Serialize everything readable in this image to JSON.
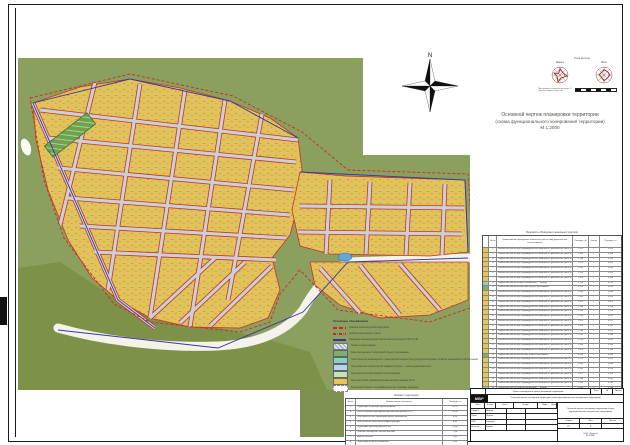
{
  "sheet": {
    "title": {
      "line1": "Основной чертеж планировки территории",
      "line2": "(схема функционального зонирования территории)",
      "line3": "М 1:2000"
    },
    "north_label": "N"
  },
  "wind": {
    "caption": "Роза ветров",
    "left_label": "Январь",
    "right_label": "Июль",
    "note1": "Повторяемость направлений ветра, %",
    "note2": "Средняя скорость ветра, м/с",
    "scale_label": "Линейный масштаб 1:2000"
  },
  "colors": {
    "zone_residential": "#e6c455",
    "zone_green": "#7fb069",
    "zone_engineering": "#8fcfc0",
    "zone_transport": "#b8d4e8",
    "zone_agro": "#cfe3a8",
    "boundary_red": "#c3342a",
    "boundary_blue": "#3a33a6"
  },
  "legend": {
    "title": "Условные обозначения",
    "items": [
      {
        "sw_bg": "repeating-linear-gradient(90deg,#c1272d 0 4px,transparent 4px 6px)",
        "sw_h": "1.6px",
        "sw_bd": "none",
        "label": "Граница проектируемой территории"
      },
      {
        "sw_bg": "repeating-linear-gradient(90deg,#c1272d 0 3px,transparent 3px 4px,#c1272d 4px 4.6px,transparent 4.6px 6px)",
        "sw_h": "1.6px",
        "sw_bd": "none",
        "label": "Граница населенного пункта"
      },
      {
        "sw_bg": "#3a33a6",
        "sw_h": "1.4px",
        "sw_bd": "none",
        "label": "Охранная зона воздушной линии электропередачи ЛЭП 10 кВ"
      },
      {
        "sw_bg": "repeating-linear-gradient(45deg,#aab4ba 0 1.5px,#e8ecee 1.5px 3px)",
        "sw_h": "5px",
        "sw_bd": "0.4px solid #778",
        "label": "Земли лесного фонда"
      },
      {
        "sw_bg": "#7fb069",
        "sw_h": "5px",
        "sw_bd": "0.4px solid #567",
        "label": "Зона озелененных территорий общего пользования"
      },
      {
        "sw_bg": "#8fcfc0",
        "sw_h": "5px",
        "sw_bd": "0.4px solid #567",
        "label": "Зона объектов инженерной и транспортной инфраструктуры (проектируемые объекты инженерного обеспечения)"
      },
      {
        "sw_bg": "#b8d4e8",
        "sw_h": "5px",
        "sw_bd": "0.4px solid #567",
        "label": "Зона объектов транспортной инфраструктуры — улично-дорожная сеть"
      },
      {
        "sw_bg": "#cfe3a8",
        "sw_h": "5px",
        "sw_bd": "0.4px solid #567",
        "label": "Зона сельскохозяйственного использования"
      },
      {
        "sw_bg": "#e6c455",
        "sw_h": "5px",
        "sw_bd": "0.4px solid #766",
        "label": "Зона застройки индивидуальными жилыми домами (Ж-1)"
      },
      {
        "sw_bg": "#ffffff",
        "sw_h": "5px",
        "sw_bd": "0.5px dashed #888",
        "label": "Территории общего пользования (улицы, проезды, проходы)"
      }
    ]
  },
  "plots_table": {
    "caption": "Ведомость образуемых земельных участков",
    "col_n": "№ п/п",
    "col_name": "Наименование образуемого земельного участка (вид разрешенного использования)",
    "col_area": "Площадь, м²",
    "col_cnt": "Кол-во",
    "col_note": "Площадь, га",
    "rows": [
      {
        "n": "1",
        "color": "#e6c455",
        "name": "Земельный участок для индивидуального жилищного строительства (зона Ж-1)",
        "area": "1 512",
        "cnt": "1",
        "note": "0,151"
      },
      {
        "n": "2",
        "color": "#e6c455",
        "name": "Земельный участок для индивидуального жилищного строительства (зона Ж-1)",
        "area": "1 485",
        "cnt": "1",
        "note": "0,149"
      },
      {
        "n": "3",
        "color": "#e6c455",
        "name": "Земельный участок для индивидуального жилищного строительства (зона Ж-1)",
        "area": "1 500",
        "cnt": "1",
        "note": "0,150"
      },
      {
        "n": "4",
        "color": "#e6c455",
        "name": "Земельный участок для индивидуального жилищного строительства (зона Ж-1)",
        "area": "1 523",
        "cnt": "1",
        "note": "0,152"
      },
      {
        "n": "5",
        "color": "#e6c455",
        "name": "Земельный участок для индивидуального жилищного строительства (зона Ж-1)",
        "area": "1 497",
        "cnt": "1",
        "note": "0,150"
      },
      {
        "n": "6",
        "color": "#e6c455",
        "name": "Земельный участок для индивидуального жилищного строительства (зона Ж-1)",
        "area": "1 505",
        "cnt": "1",
        "note": "0,151"
      },
      {
        "n": "7",
        "color": "#e6c455",
        "name": "Земельный участок для индивидуального жилищного строительства (зона Ж-1)",
        "area": "1 478",
        "cnt": "1",
        "note": "0,148"
      },
      {
        "n": "8",
        "color": "#8fcfc0",
        "name": "Земельный участок общего пользования — проезд",
        "area": "2 150",
        "cnt": "1",
        "note": "0,215"
      },
      {
        "n": "9",
        "color": "#7fb069",
        "name": "Земельный участок озеленения общего пользования",
        "area": "5 230",
        "cnt": "1",
        "note": "0,523"
      },
      {
        "n": "10",
        "color": "#e6c455",
        "name": "Земельный участок для индивидуального жилищного строительства (зона Ж-1)",
        "area": "1 490",
        "cnt": "1",
        "note": "0,149"
      },
      {
        "n": "11",
        "color": "#e6c455",
        "name": "Земельный участок для индивидуального жилищного строительства (зона Ж-1)",
        "area": "1 502",
        "cnt": "1",
        "note": "0,150"
      },
      {
        "n": "12",
        "color": "#e6c455",
        "name": "Земельный участок для индивидуального жилищного строительства (зона Ж-1)",
        "area": "1 515",
        "cnt": "1",
        "note": "0,152"
      },
      {
        "n": "13",
        "color": "#e6c455",
        "name": "Земельный участок для индивидуального жилищного строительства (зона Ж-1)",
        "area": "1 488",
        "cnt": "1",
        "note": "0,149"
      },
      {
        "n": "14",
        "color": "#e6c455",
        "name": "Земельный участок для индивидуального жилищного строительства (зона Ж-1)",
        "area": "1 500",
        "cnt": "1",
        "note": "0,150"
      },
      {
        "n": "15",
        "color": "#e6c455",
        "name": "Земельный участок для индивидуального жилищного строительства (зона Ж-1)",
        "area": "1 534",
        "cnt": "1",
        "note": "0,153"
      },
      {
        "n": "16",
        "color": "#e6c455",
        "name": "Земельный участок для индивидуального жилищного строительства (зона Ж-1)",
        "area": "1 470",
        "cnt": "1",
        "note": "0,147"
      },
      {
        "n": "17",
        "color": "#e6c455",
        "name": "Земельный участок для индивидуального жилищного строительства (зона Ж-1)",
        "area": "1 495",
        "cnt": "1",
        "note": "0,150"
      },
      {
        "n": "18",
        "color": "#e6c455",
        "name": "Земельный участок для индивидуального жилищного строительства (зона Ж-1)",
        "area": "1 508",
        "cnt": "1",
        "note": "0,151"
      },
      {
        "n": "19",
        "color": "#e6c455",
        "name": "Земельный участок для индивидуального жилищного строительства (зона Ж-1)",
        "area": "1 482",
        "cnt": "1",
        "note": "0,148"
      },
      {
        "n": "20",
        "color": "#e6c455",
        "name": "Земельный участок для индивидуального жилищного строительства (зона Ж-1)",
        "area": "1 519",
        "cnt": "1",
        "note": "0,152"
      },
      {
        "n": "21",
        "color": "#e6c455",
        "name": "Земельный участок для индивидуального жилищного строительства (зона Ж-1)",
        "area": "1 500",
        "cnt": "1",
        "note": "0,150"
      },
      {
        "n": "22",
        "color": "#e6c455",
        "name": "Земельный участок для индивидуального жилищного строительства (зона Ж-1)",
        "area": "1 476",
        "cnt": "1",
        "note": "0,148"
      },
      {
        "n": "23",
        "color": "#7fb069",
        "name": "Земельный участок озеленения общего пользования",
        "area": "3 640",
        "cnt": "1",
        "note": "0,364"
      },
      {
        "n": "24",
        "color": "#e6c455",
        "name": "Земельный участок для индивидуального жилищного строительства (зона Ж-1)",
        "area": "1 511",
        "cnt": "1",
        "note": "0,151"
      },
      {
        "n": "25",
        "color": "#e6c455",
        "name": "Земельный участок для индивидуального жилищного строительства (зона Ж-1)",
        "area": "1 493",
        "cnt": "1",
        "note": "0,149"
      },
      {
        "n": "26",
        "color": "#e6c455",
        "name": "Земельный участок для индивидуального жилищного строительства (зона Ж-1)",
        "area": "1 500",
        "cnt": "1",
        "note": "0,150"
      },
      {
        "n": "27",
        "color": "#e6c455",
        "name": "Земельный участок для индивидуального жилищного строительства (зона Ж-1)",
        "area": "1 527",
        "cnt": "1",
        "note": "0,153"
      },
      {
        "n": "28",
        "color": "#e6c455",
        "name": "Земельный участок для индивидуального жилищного строительства (зона Ж-1)",
        "area": "1 466",
        "cnt": "1",
        "note": "0,147"
      },
      {
        "n": "29",
        "color": "#e6c455",
        "name": "Земельный участок для индивидуального жилищного строительства (зона Ж-1)",
        "area": "1 504",
        "cnt": "1",
        "note": "0,150"
      },
      {
        "n": "30",
        "color": "#8fcfc0",
        "name": "Земельный участок общего пользования — проезд",
        "area": "1 980",
        "cnt": "1",
        "note": "0,198"
      },
      {
        "n": "31",
        "color": "#e6c455",
        "name": "Земельный участок для индивидуального жилищного строительства (зона Ж-1)",
        "area": "1 498",
        "cnt": "1",
        "note": "0,150"
      },
      {
        "n": "32",
        "color": "#e6c455",
        "name": "Земельный участок для индивидуального жилищного строительства (зона Ж-1)",
        "area": "1 515",
        "cnt": "1",
        "note": "0,152"
      },
      {
        "n": "33",
        "color": "#e6c455",
        "name": "Земельный участок для индивидуального жилищного строительства (зона Ж-1)",
        "area": "1 487",
        "cnt": "1",
        "note": "0,149"
      },
      {
        "n": "34",
        "color": "#e6c455",
        "name": "Земельный участок для индивидуального жилищного строительства (зона Ж-1)",
        "area": "1 500",
        "cnt": "1",
        "note": "0,150"
      },
      {
        "n": "35",
        "color": "#e6c455",
        "name": "Земельный участок для индивидуального жилищного строительства (зона Ж-1)",
        "area": "1 472",
        "cnt": "1",
        "note": "0,147"
      },
      {
        "n": "36",
        "color": "#e6c455",
        "name": "Земельный участок для индивидуального жилищного строительства (зона Ж-1)",
        "area": "1 526",
        "cnt": "1",
        "note": "0,153"
      },
      {
        "n": "37",
        "color": "#e6c455",
        "name": "Земельный участок для индивидуального жилищного строительства (зона Ж-1)",
        "area": "1 509",
        "cnt": "1",
        "note": "0,151"
      },
      {
        "n": "38",
        "color": "#8fcfc0",
        "name": "Земельный участок для размещения объектов инженерной инфраструктуры",
        "area": "860",
        "cnt": "1",
        "note": "0,086"
      }
    ]
  },
  "balance_table": {
    "caption": "Баланс территории",
    "col_n": "№ п/п",
    "col_name": "Наименование показателя",
    "col_val": "Площадь, га",
    "rows": [
      {
        "n": "1",
        "name": "Территория в границах проектирования",
        "val": "82,70"
      },
      {
        "n": "2",
        "name": "Зона застройки индивидуальными жилыми домами (Ж-1)",
        "val": "54,30"
      },
      {
        "n": "3",
        "name": "Зона озелененных территорий общего пользования",
        "val": "6,20"
      },
      {
        "n": "4",
        "name": "Зона объектов инженерной инфраструктуры",
        "val": "0,85"
      },
      {
        "n": "5",
        "name": "Территория улично-дорожной сети",
        "val": "12,40"
      },
      {
        "n": "6",
        "name": "Зеленые насаждения, лесные массивы",
        "val": "7,10"
      },
      {
        "n": "7",
        "name": "Водные объекты",
        "val": "0,45"
      },
      {
        "n": "8",
        "name": "Территории общего пользования",
        "val": "1,40"
      }
    ]
  },
  "stamp": {
    "logo": "МВР",
    "top_text": "Проект планировки и проект межевания территории",
    "top_cells": [
      "Лист",
      "№",
      "Листов"
    ],
    "sub_text": "Основной чертеж планировки территории (схема функционального зонирования территории)",
    "cols": [
      "Изм.",
      "Кол.уч",
      "Лист",
      "№ док.",
      "Подп.",
      "Дата"
    ],
    "roles": [
      {
        "role": "Разраб.",
        "name": "Иванов"
      },
      {
        "role": "Пров.",
        "name": "Петров"
      },
      {
        "role": "ГАП",
        "name": "Сидоров"
      },
      {
        "role": "Н.контр.",
        "name": "Козлов"
      }
    ],
    "doc_title": "Основной чертеж планировки территории (схема функционального зонирования территории)",
    "stage_h": [
      "Стадия",
      "Лист",
      "Листов"
    ],
    "stage_v": [
      "П",
      "1",
      ""
    ],
    "org": "ООО «Проект»",
    "scale": "М 1:2000"
  }
}
